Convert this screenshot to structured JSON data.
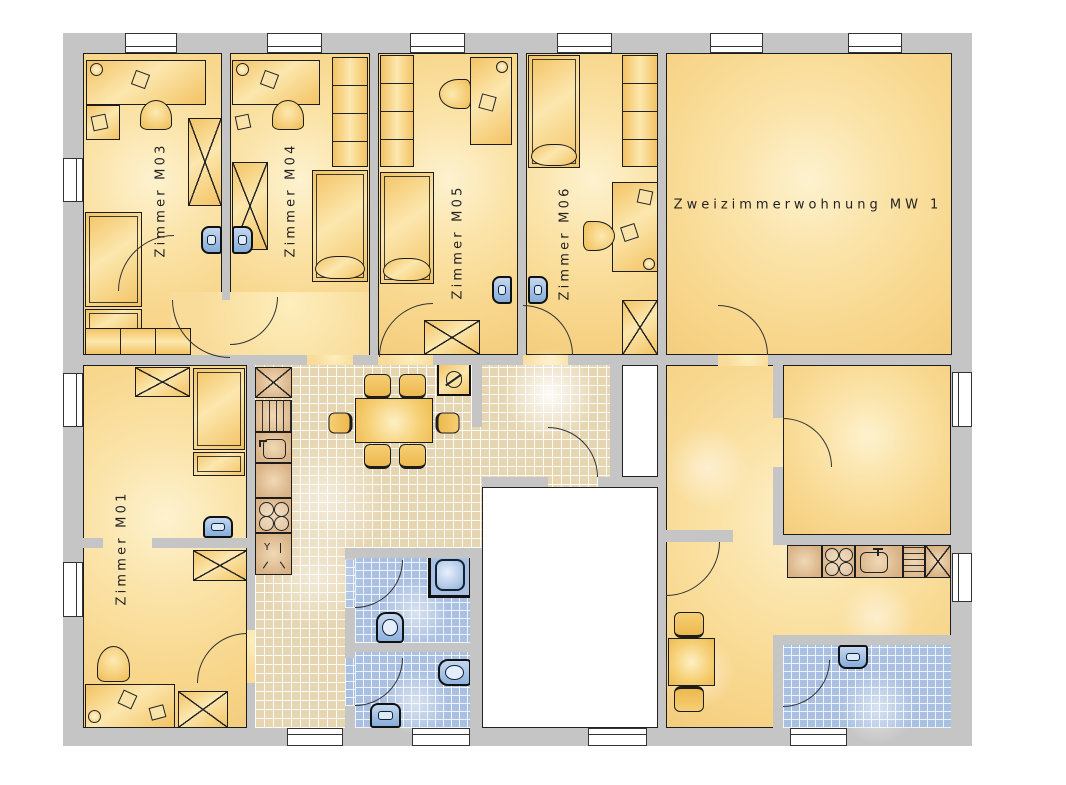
{
  "plan": {
    "rooms": [
      {
        "id": "m03",
        "label": "Zimmer M03"
      },
      {
        "id": "m04",
        "label": "Zimmer M04"
      },
      {
        "id": "m05",
        "label": "Zimmer M05"
      },
      {
        "id": "m06",
        "label": "Zimmer M06"
      },
      {
        "id": "m01",
        "label": "Zimmer M01"
      },
      {
        "id": "mw1",
        "label": "Zweizimmerwohnung MW 1"
      }
    ],
    "symbols": {
      "utility": "Y"
    },
    "colors": {
      "wall": "#c5c5c5",
      "room_fill": "#f8d78d",
      "room_highlight": "#fdf2cf",
      "corridor_tile": "#e6d5b1",
      "bath_tile": "#a9c0e2",
      "tile_grout": "#ffffff",
      "furniture": "#f3c364",
      "kitchen_unit": "#d9b286",
      "fixture_blue": "#9cbbe4",
      "outline": "#1c1c1c",
      "floor_white": "#ffffff"
    }
  }
}
